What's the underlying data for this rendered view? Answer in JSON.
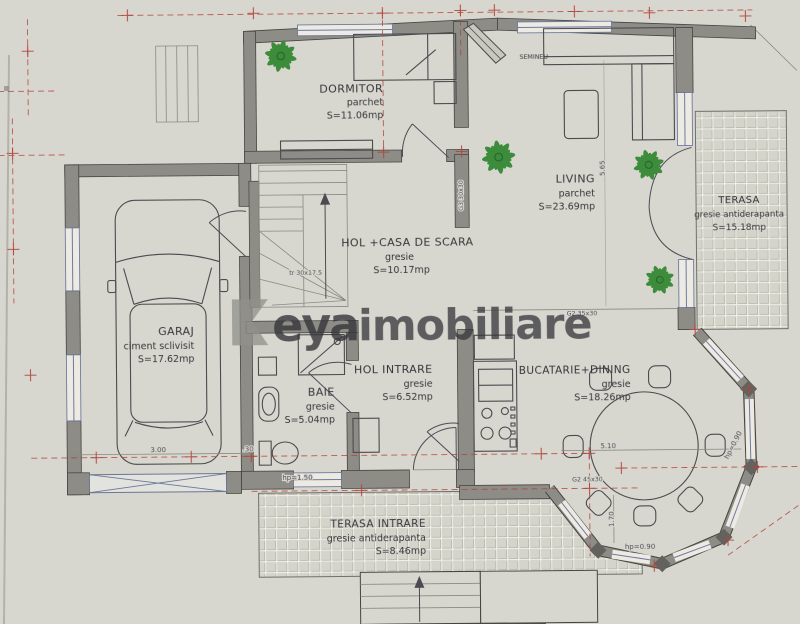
{
  "watermark": {
    "logo_text": "eya",
    "brand_text": "imobiliare"
  },
  "rooms": {
    "dormitor": {
      "name": "DORMITOR",
      "finish": "parchet",
      "area": "S=11.06mp"
    },
    "living": {
      "name": "LIVING",
      "finish": "parchet",
      "area": "S=23.69mp"
    },
    "terasa": {
      "name": "TERASA",
      "finish": "gresie antiderapanta",
      "area": "S=15.18mp"
    },
    "garaj": {
      "name": "GARAJ",
      "finish": "ciment sclivisit",
      "area": "S=17.62mp"
    },
    "hol_scara": {
      "name": "HOL +CASA DE SCARA",
      "finish": "gresie",
      "area": "S=10.17mp"
    },
    "hol_intrare": {
      "name": "HOL INTRARE",
      "finish": "gresie",
      "area": "S=6.52mp"
    },
    "baie": {
      "name": "BAIE",
      "finish": "gresie",
      "area": "S=5.04mp"
    },
    "bucatarie_dining": {
      "name": "BUCATARIE+DINING",
      "finish": "gresie",
      "area": "S=18.26mp"
    },
    "terasa_intrare": {
      "name": "TERASA INTRARE",
      "finish": "gresie antiderapanta",
      "area": "S=8.46mp"
    }
  },
  "annotations": {
    "semineu": "SEMINEU",
    "stair_note": "tr 30x17.5",
    "g3_label": "G3 30x30",
    "g2_label_a": "G2 35x30",
    "g2_label_b": "G2 45x30"
  },
  "dimensions": {
    "garage_width": "3.00",
    "wall_thickness": ".30",
    "baie_window": "hp=1.50",
    "dining_width": "5.10",
    "dining_side": "1.70",
    "bay_parapet": "hp=0.90",
    "bay_parapet_right": "hp=0.90",
    "living_depth": "5.65"
  },
  "colors": {
    "paper": "#d8d7cf",
    "wall_gray": "#8d8c87",
    "mark_red": "#b2443b",
    "watermark_red": "#c63f55",
    "watermark_gray": "#90908b",
    "window_blue": "#6e7b9d",
    "plant_green": "#3c8c3c",
    "tile_line": "#b6b5aa"
  }
}
